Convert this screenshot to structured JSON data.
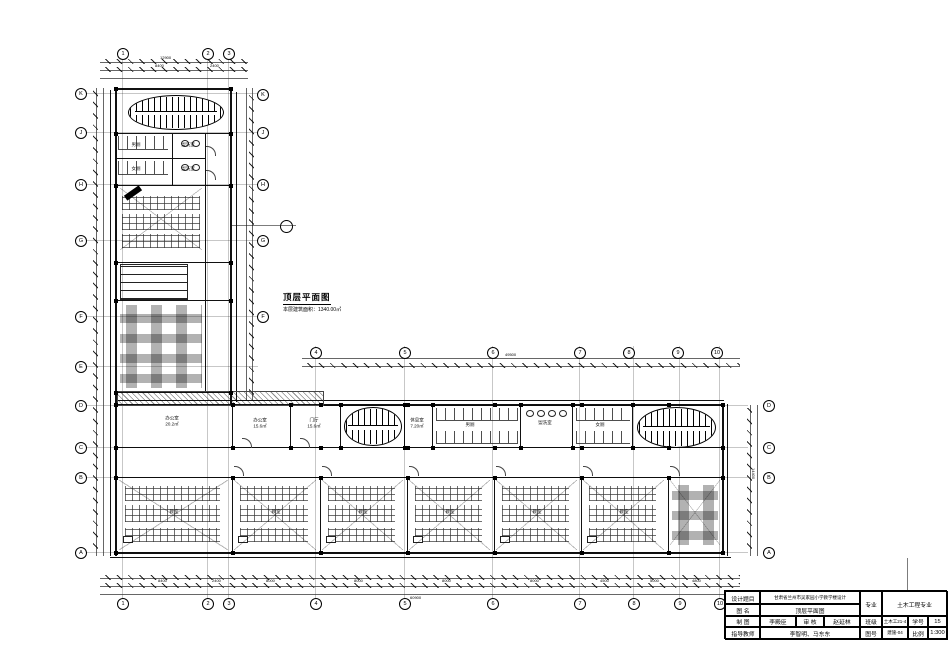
{
  "drawing": {
    "plan_title": "顶层平面图",
    "area_note": "本层建筑面积：1340.00㎡"
  },
  "axes": {
    "top": [
      "1",
      "2",
      "3"
    ],
    "mid": [
      "4",
      "5",
      "6",
      "7",
      "8",
      "9",
      "10"
    ],
    "bottom": [
      "1",
      "2",
      "3",
      "4",
      "5",
      "6",
      "7",
      "8",
      "9",
      "10"
    ],
    "left": [
      "K",
      "J",
      "H",
      "G",
      "F",
      "E",
      "D",
      "C",
      "B",
      "A"
    ],
    "right_wing": [
      "K",
      "J",
      "H",
      "G",
      "F"
    ],
    "right_main": [
      "D",
      "C",
      "B",
      "A"
    ]
  },
  "dimensions": {
    "top_total": "12900",
    "top_segments": [
      "8400",
      "2400"
    ],
    "mid_total": "49500",
    "bottom_total": "60900",
    "bottom_segments": [
      "8400",
      "2400",
      "8000",
      "8000",
      "8000",
      "8000",
      "4500",
      "5000",
      "4800"
    ],
    "right_total": "14400"
  },
  "rooms": [
    {
      "name": "男厕",
      "area": ""
    },
    {
      "name": "盥洗室",
      "area": ""
    },
    {
      "name": "女厕",
      "area": ""
    },
    {
      "name": "盥洗室",
      "area": ""
    },
    {
      "name": "办公室",
      "area": "20.2㎡"
    },
    {
      "name": "办公室",
      "area": "15.6㎡"
    },
    {
      "name": "门厅",
      "area": "15.6㎡"
    },
    {
      "name": "休息室",
      "area": "7.20㎡"
    },
    {
      "name": "男厕",
      "area": ""
    },
    {
      "name": "盥洗室",
      "area": ""
    },
    {
      "name": "女厕",
      "area": ""
    },
    {
      "name": "教室",
      "area": ""
    },
    {
      "name": "教室",
      "area": ""
    },
    {
      "name": "教室",
      "area": ""
    },
    {
      "name": "教室",
      "area": ""
    },
    {
      "name": "教室",
      "area": ""
    },
    {
      "name": "教室",
      "area": ""
    }
  ],
  "titleblock": {
    "design_topic_label": "设计题目",
    "design_topic": "甘肃省兰州市吴家园小学教学楼设计",
    "drawing_name_label": "图  名",
    "drawing_name": "顶层平面图",
    "drafter_label": "制  图",
    "drafter": "李殿臣",
    "reviewer_label": "审  核",
    "reviewer": "赵延林",
    "advisor_label": "指导教师",
    "advisor": "李智明、马东东",
    "major_label": "专业",
    "major": "土木工程专业",
    "class_label": "班级",
    "class_value": "土木工21-4",
    "student_id_label": "学号",
    "student_id": "15",
    "figure_no_label": "图号",
    "figure_no": "建施-04",
    "scale_label": "比例",
    "scale_value": "1:300"
  }
}
